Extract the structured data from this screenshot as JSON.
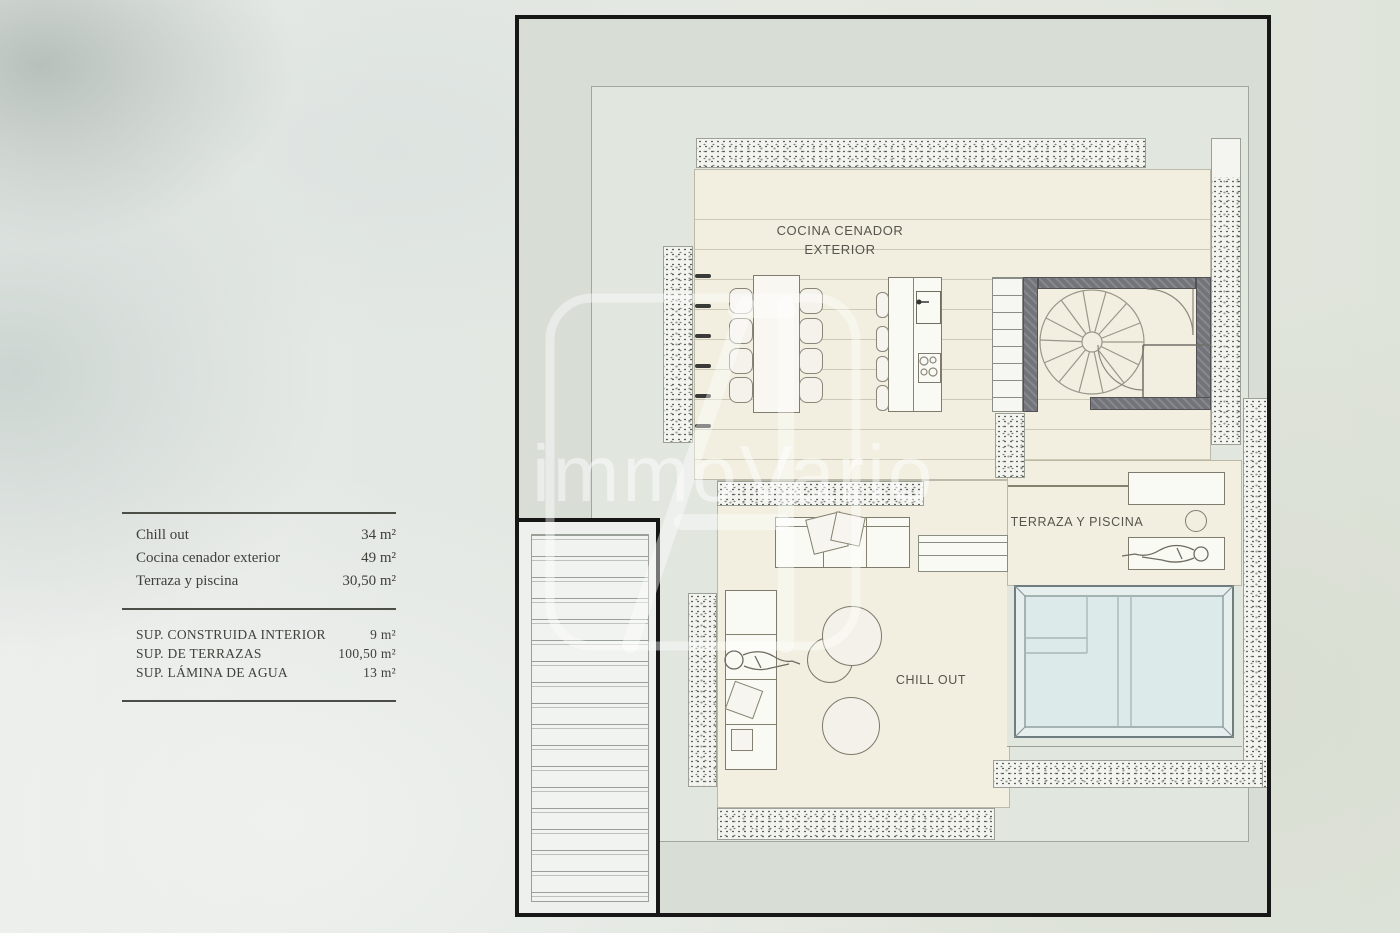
{
  "watermark": {
    "brand": "immoVario"
  },
  "legend": {
    "areas": [
      {
        "label": "Chill out",
        "value": "34 m²"
      },
      {
        "label": "Cocina cenador exterior",
        "value": "49 m²"
      },
      {
        "label": "Terraza y piscina",
        "value": "30,50 m²"
      }
    ],
    "totals": [
      {
        "label": "SUP. CONSTRUIDA INTERIOR",
        "value": "9 m²"
      },
      {
        "label": "SUP. DE TERRAZAS",
        "value": "100,50 m²"
      },
      {
        "label": "SUP. LÁMINA DE AGUA",
        "value": "13 m²"
      }
    ]
  },
  "plan": {
    "rooms": {
      "cocina_line1": "COCINA CENADOR",
      "cocina_line2": "EXTERIOR",
      "terraza_label": "TERRAZA Y PISCINA",
      "chillout_label": "CHILL OUT"
    }
  },
  "colors": {
    "deck_cream": "#f2efe1",
    "pool_water": "#dcebea",
    "wall_dark": "#73747a",
    "plan_border": "#171717",
    "background_sage": "#e3e8e1"
  }
}
